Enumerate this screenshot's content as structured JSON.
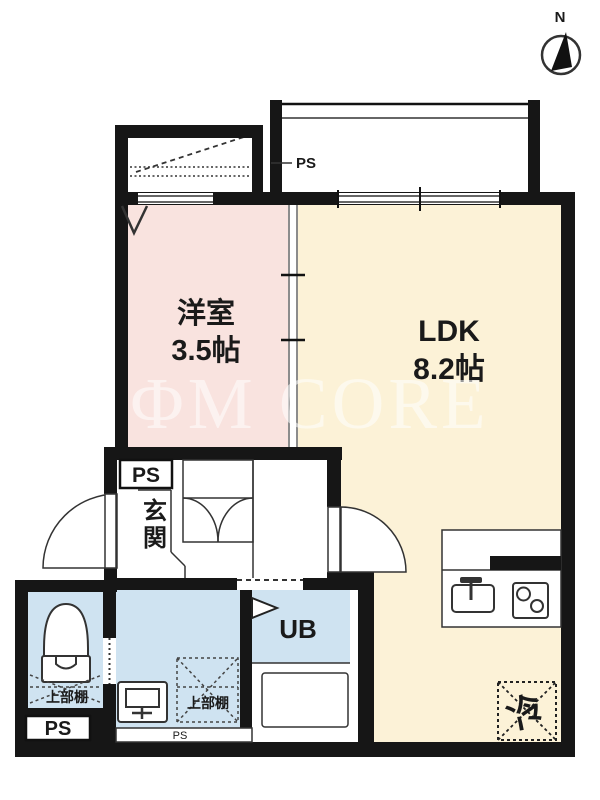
{
  "compass": {
    "north": "N"
  },
  "rooms": {
    "western": {
      "name": "洋室",
      "size": "3.5帖",
      "color": "#f9e3df"
    },
    "ldk": {
      "name": "LDK",
      "size": "8.2帖",
      "color": "#fcf2d7"
    },
    "entrance": {
      "name": "玄関"
    },
    "unit_bath": {
      "name": "UB"
    },
    "refrigerator": {
      "label": "冷"
    }
  },
  "ps": {
    "balcony": "PS",
    "hall": "PS",
    "toilet": "PS",
    "washroom": "PS"
  },
  "shelves": {
    "toilet": "上部棚",
    "washroom": "上部棚"
  },
  "watermark": {
    "text": "ΦM CORE"
  },
  "colors": {
    "wall": "#161616",
    "wet_area": "#cfe3f1",
    "western_room": "#f9e3df",
    "ldk": "#fcf2d7",
    "line": "#333333"
  }
}
